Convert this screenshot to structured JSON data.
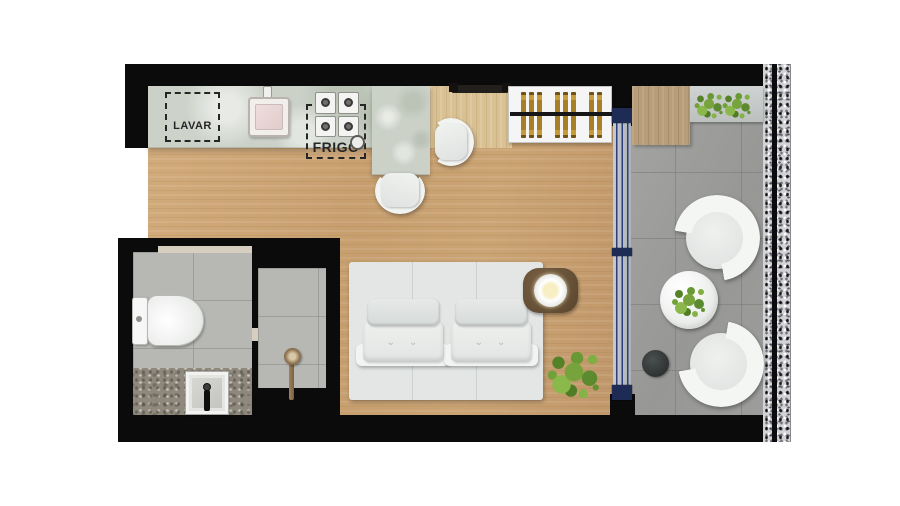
{
  "title": "Studio apartment floor plan",
  "labels": {
    "washing_area": "LAVAR",
    "fridge": "FRIGO"
  },
  "palette": {
    "wall_black": "#0b0b0b",
    "wood_floor": "#c9a173",
    "entry_wood": "#d9c193",
    "counter_marble": "#cbd1c7",
    "balcony_tile": "#9d9d9b",
    "bathroom_tile": "#b7b8b4",
    "bathroom_counter": "#8e887d",
    "rug_gray": "#e3e6e4",
    "sofa_white": "#eef0ee",
    "side_table_brown": "#6d573e",
    "door_frame_navy": "#1e2c55",
    "hanger_gold": "#b68c2e",
    "plant_green": "#76a33c",
    "speckle_wall": "#d2d3d5"
  },
  "rooms": {
    "kitchen_items": [
      "washing-machine-space",
      "kitchen-sink",
      "cooktop",
      "fridge-space",
      "bar-stool",
      "bar-stool"
    ],
    "entry_items": [
      "entry-door"
    ],
    "closet_items": [
      "clothes-rail",
      "hangers"
    ],
    "living_items": [
      "rug",
      "sofa-bed",
      "pillows",
      "side-table",
      "table-lamp",
      "potted-plant"
    ],
    "bathroom_items": [
      "toilet",
      "vanity-sink",
      "shower-head"
    ],
    "balcony_items": [
      "deck-cabinet",
      "plant-shelf",
      "plant",
      "plant",
      "armchair",
      "armchair",
      "round-table",
      "table-plant",
      "dark-planter"
    ],
    "openings": [
      "sliding-glass-door",
      "bathroom-door-threshold"
    ]
  }
}
